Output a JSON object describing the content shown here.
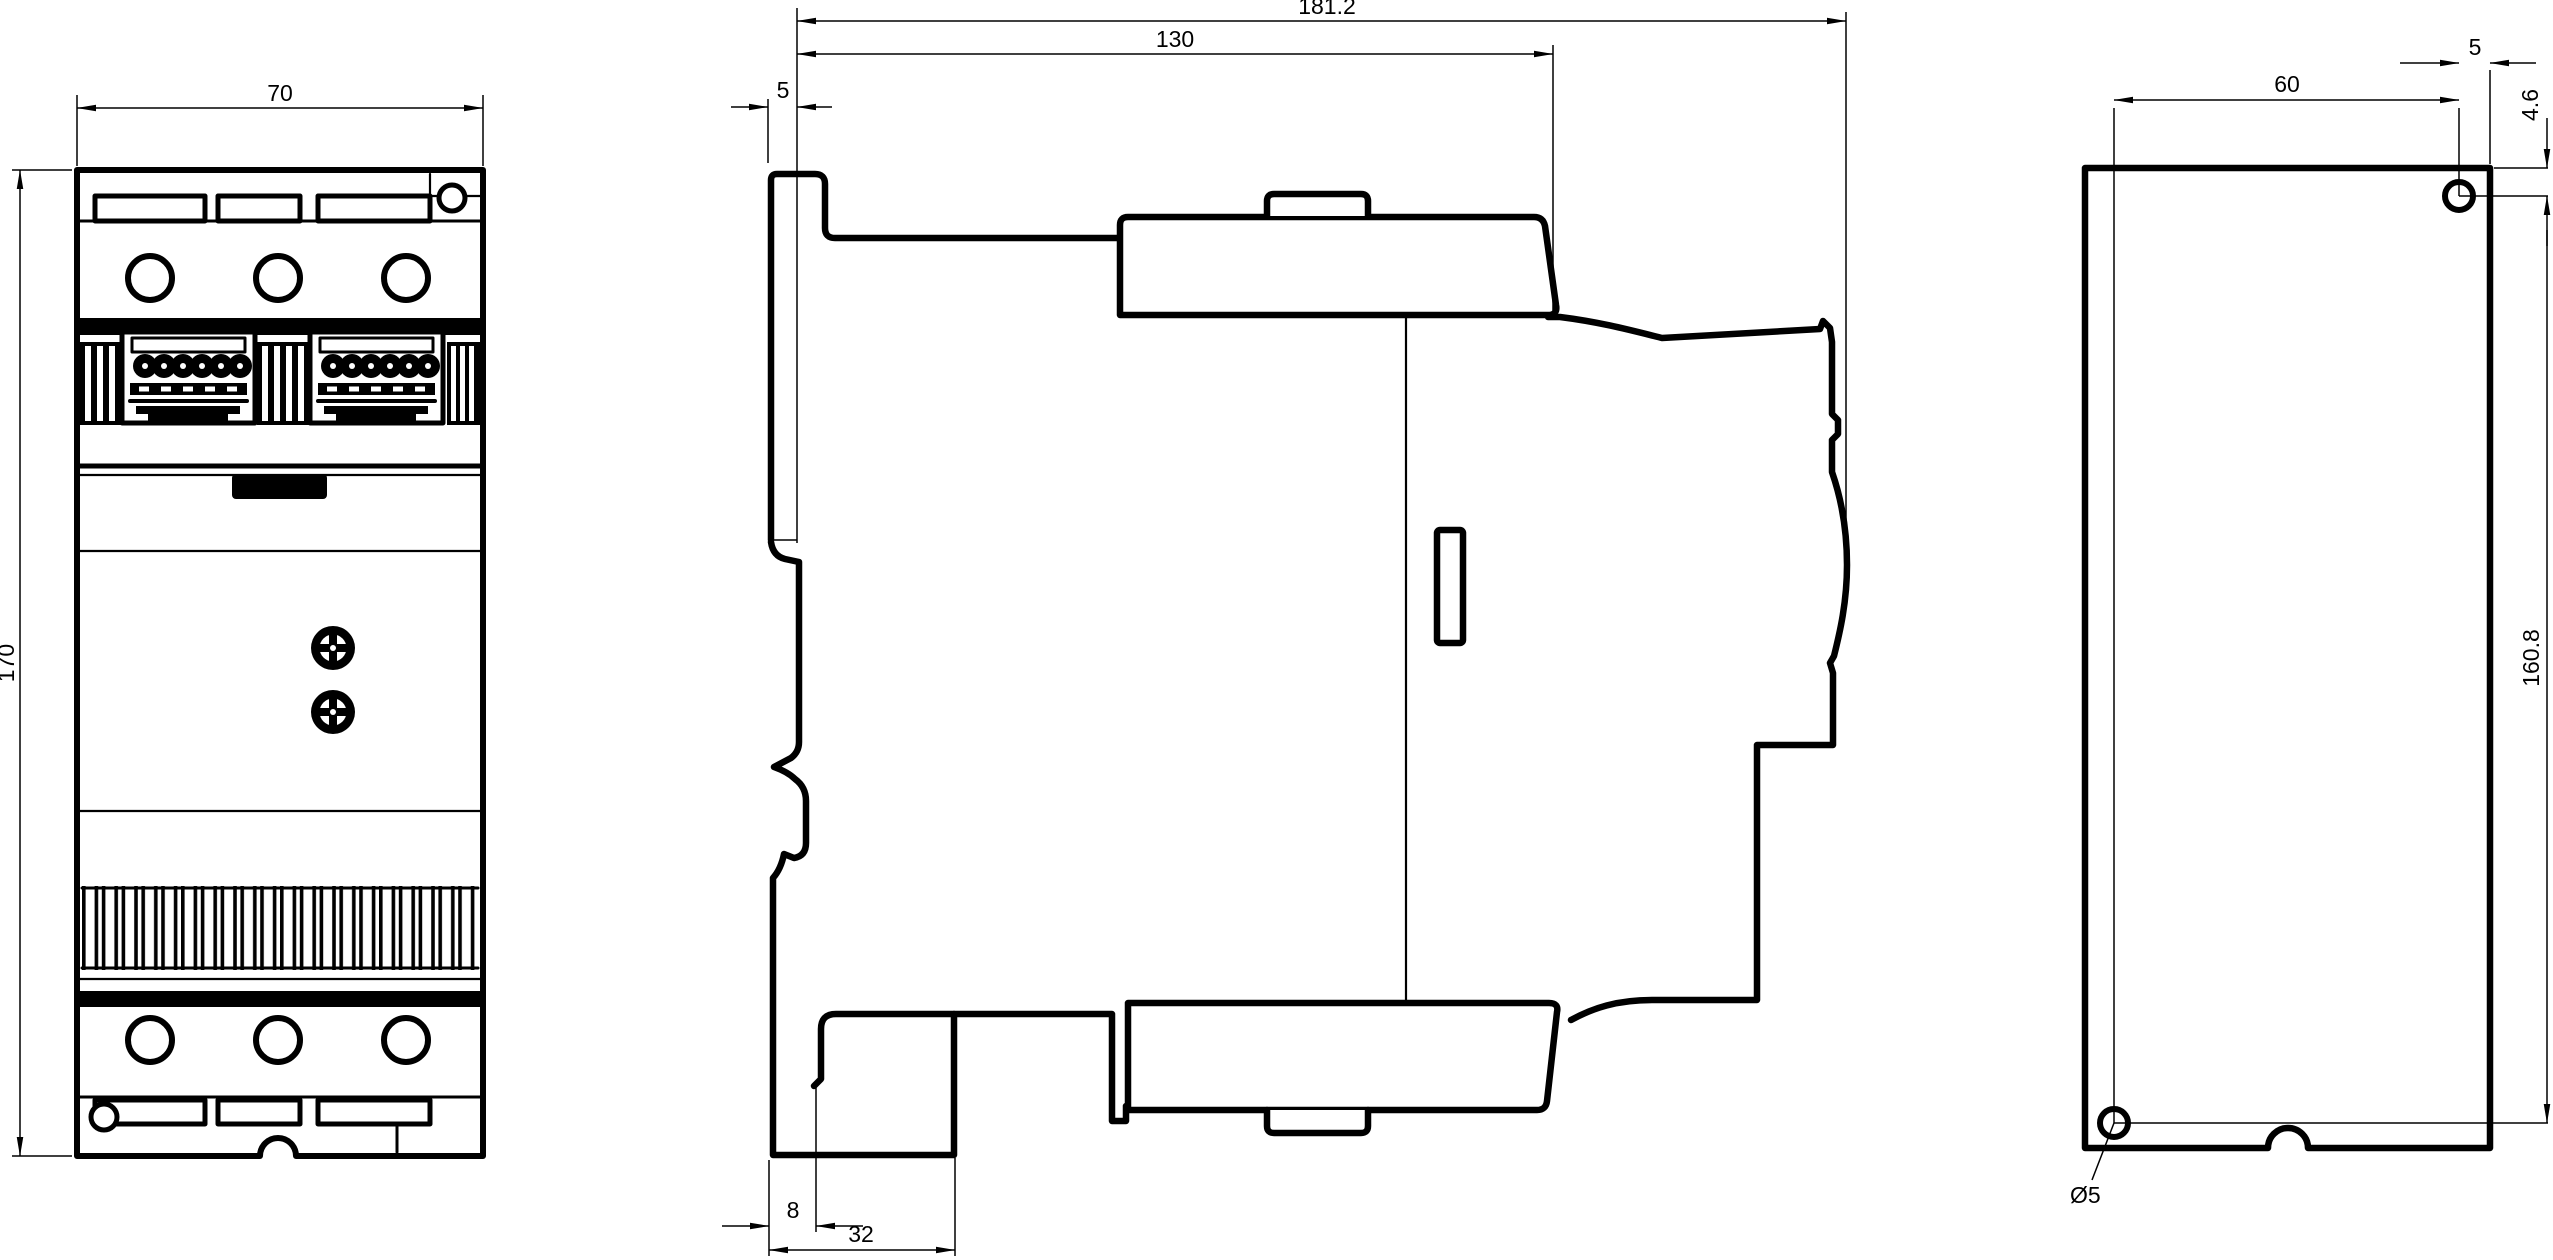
{
  "drawing_type": "dimensional-drawing",
  "colors": {
    "line": "#000000",
    "background": "#ffffff"
  },
  "views": {
    "front": {
      "dims": {
        "width": "70",
        "height": "170"
      }
    },
    "side": {
      "dims": {
        "total_depth": "181.2",
        "cover_depth": "130",
        "rail_offset": "5",
        "foot_step": "8",
        "foot_depth": "32"
      }
    },
    "rear": {
      "dims": {
        "hole_spacing_horizontal": "60",
        "hole_edge_offset": "5",
        "hole_top_offset": "4.6",
        "hole_spacing_vertical": "160.8",
        "hole_diameter": "Ø5"
      }
    }
  }
}
